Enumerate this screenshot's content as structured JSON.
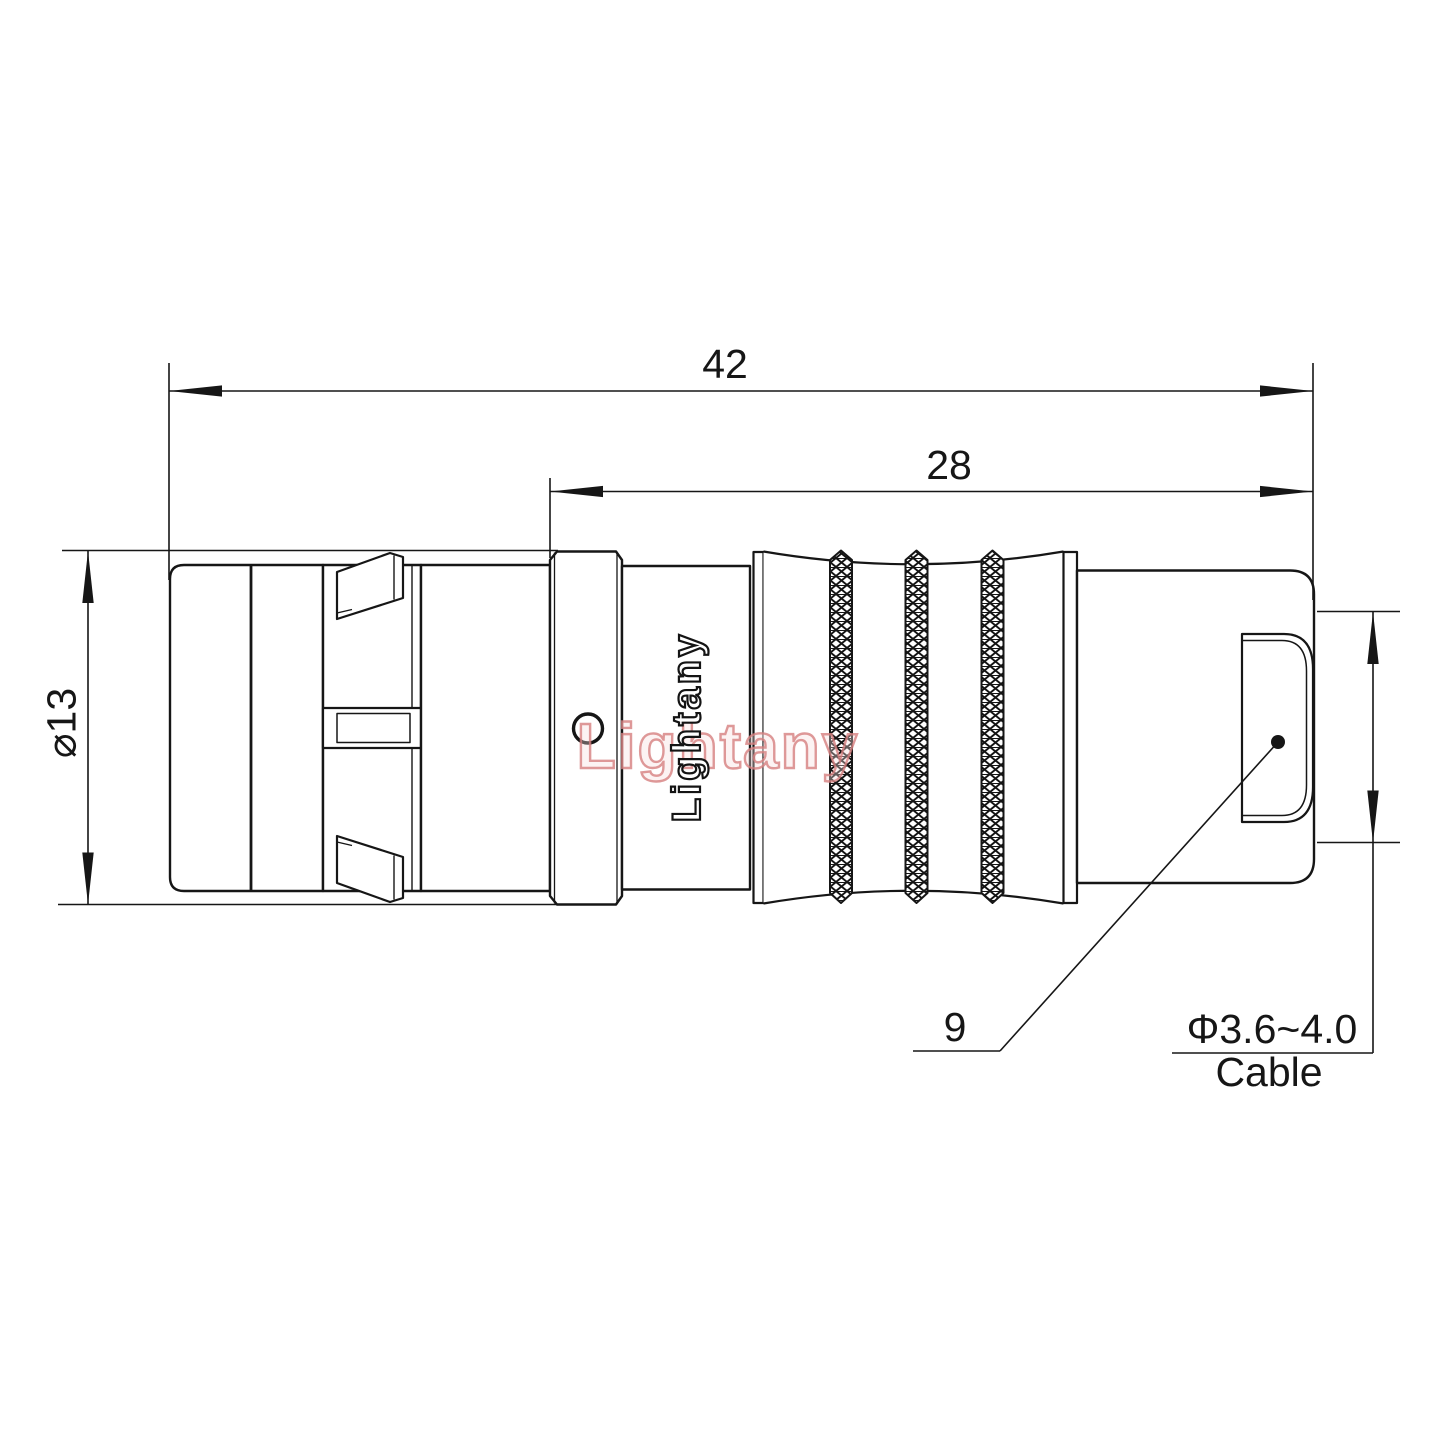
{
  "drawing": {
    "type": "connector-technical-drawing",
    "colors": {
      "line": "#161616",
      "background": "#ffffff",
      "watermark_pink": "#d68080"
    },
    "dims": {
      "overall_length": "42",
      "insert_length": "28",
      "shell_diameter": "⌀13",
      "nut_width": "9",
      "cable_diameter": "Φ3.6~4.0",
      "cable_label": "Cable"
    },
    "watermark": {
      "vertical_text": "Lightany",
      "overlay_text": "Lightany"
    }
  }
}
